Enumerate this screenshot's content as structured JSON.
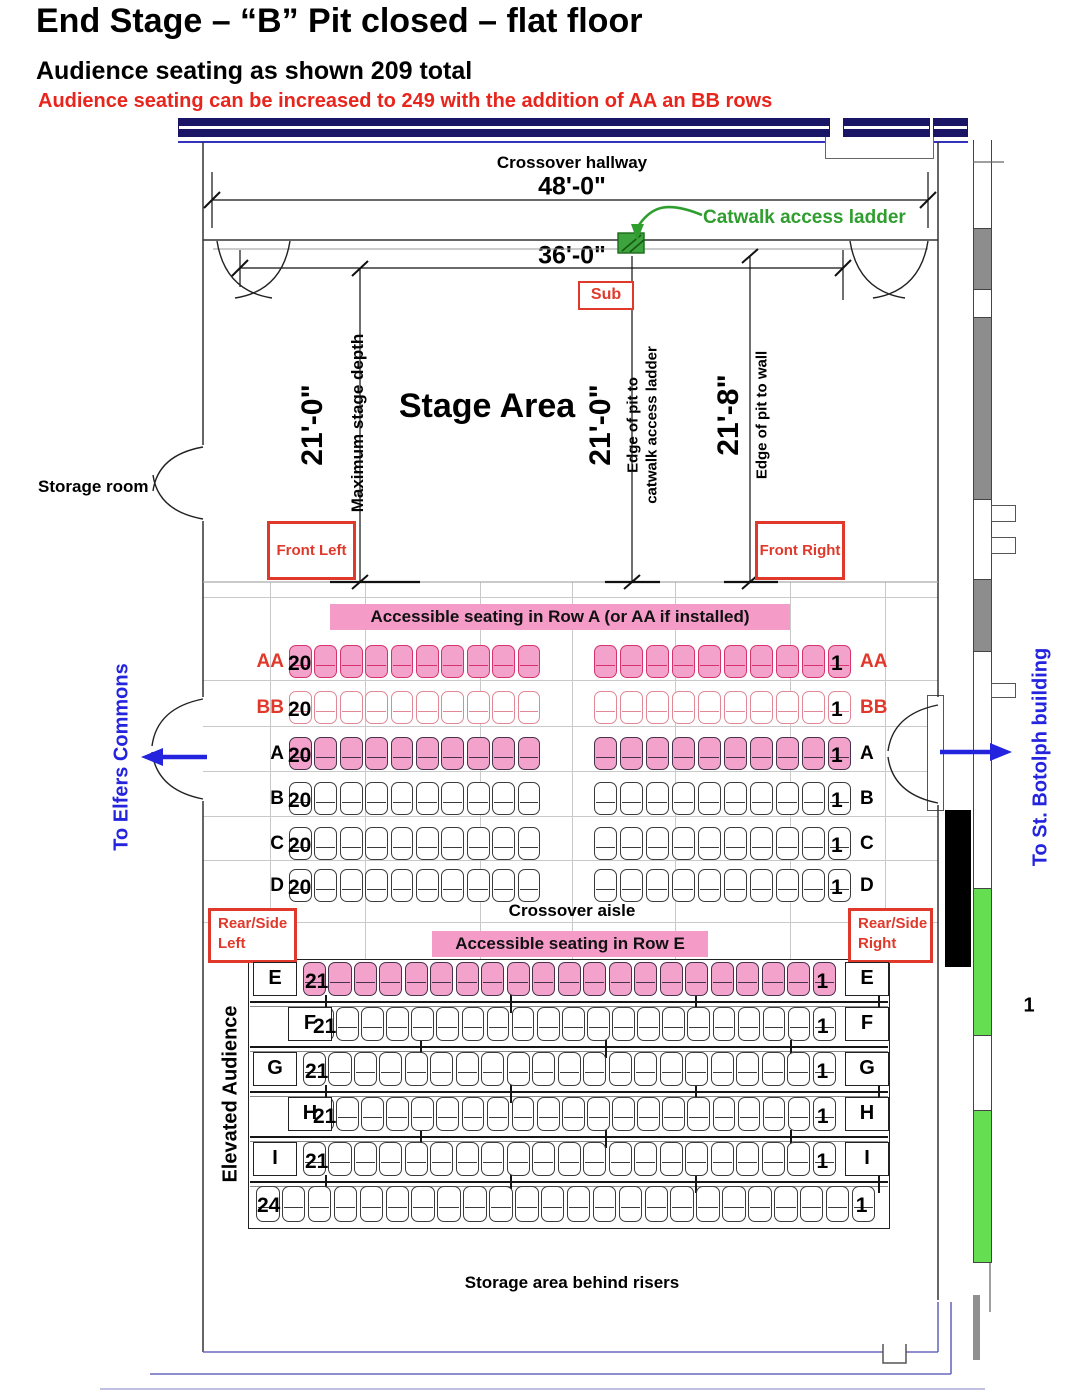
{
  "header": {
    "title": "End Stage – “B” Pit closed – flat floor",
    "subtitle": "Audience seating as shown 209 total",
    "warning": "Audience seating can be increased to 249 with the addition of AA an BB rows"
  },
  "hallway": {
    "label": "Crossover hallway",
    "width_dim": "48'-0\"",
    "stage_opening_dim": "36'-0\"",
    "catwalk_label": "Catwalk access ladder",
    "sub_label": "Sub"
  },
  "stage": {
    "area_label": "Stage Area",
    "depth_dim": "21'-0\"",
    "depth_caption": "Maximum stage depth",
    "pit_ladder_dim": "21'-0\"",
    "pit_ladder_caption_1": "Edge of pit to",
    "pit_ladder_caption_2": "catwalk access ladder",
    "pit_wall_dim": "21'-8\"",
    "pit_wall_caption": "Edge of pit to wall",
    "front_left_label": "Front Left",
    "front_right_label": "Front Right"
  },
  "exits": {
    "storage_room_label": "Storage room",
    "elfers_label": "To Elfers Commons",
    "botolph_label": "To St. Botolph building",
    "wall_number": "1"
  },
  "seating": {
    "accessible_row_a_banner": "Accessible seating in Row A (or AA if installed)",
    "accessible_row_e_banner": "Accessible seating in Row E",
    "crossover_aisle_label": "Crossover aisle",
    "rear_side_left_label": "Rear/Side Left",
    "rear_side_right_label": "Rear/Side Right",
    "elevated_label": "Elevated Audience",
    "storage_behind_label": "Storage area behind risers",
    "upper_rows": [
      {
        "label": "AA",
        "first_seat": "20",
        "last_seat": "1",
        "seats_left": 10,
        "seats_right": 10,
        "style": "pink-red",
        "label_color": "red"
      },
      {
        "label": "BB",
        "first_seat": "20",
        "last_seat": "1",
        "seats_left": 10,
        "seats_right": 10,
        "style": "white-red",
        "label_color": "red"
      },
      {
        "label": "A",
        "first_seat": "20",
        "last_seat": "1",
        "seats_left": 10,
        "seats_right": 10,
        "style": "pink-dark",
        "label_color": "black"
      },
      {
        "label": "B",
        "first_seat": "20",
        "last_seat": "1",
        "seats_left": 10,
        "seats_right": 10,
        "style": "white-dark",
        "label_color": "black"
      },
      {
        "label": "C",
        "first_seat": "20",
        "last_seat": "1",
        "seats_left": 10,
        "seats_right": 10,
        "style": "white-dark",
        "label_color": "black"
      },
      {
        "label": "D",
        "first_seat": "20",
        "last_seat": "1",
        "seats_left": 10,
        "seats_right": 10,
        "style": "white-dark",
        "label_color": "black"
      }
    ],
    "lower_rows": [
      {
        "label": "E",
        "first_seat": "21",
        "last_seat": "1",
        "seats": 21,
        "style": "pink-dark"
      },
      {
        "label": "F",
        "first_seat": "21",
        "last_seat": "1",
        "seats": 21,
        "style": "white-dark"
      },
      {
        "label": "G",
        "first_seat": "21",
        "last_seat": "1",
        "seats": 21,
        "style": "white-dark"
      },
      {
        "label": "H",
        "first_seat": "21",
        "last_seat": "1",
        "seats": 21,
        "style": "white-dark"
      },
      {
        "label": "I",
        "first_seat": "21",
        "last_seat": "1",
        "seats": 21,
        "style": "white-dark"
      }
    ],
    "back_row": {
      "first_seat": "24",
      "last_seat": "1",
      "seats": 24,
      "style": "white-dark"
    }
  },
  "colors": {
    "accent_red": "#E0392B",
    "warning_red": "#E8251D",
    "seat_pink": "#F3A3CB",
    "banner_pink": "#F49BC8",
    "wall_navy": "#1b1566",
    "exit_blue": "#2424DE",
    "catwalk_green": "#2F9E2F",
    "wall_green": "#65DF51",
    "wall_gray": "#8D8D8D"
  }
}
